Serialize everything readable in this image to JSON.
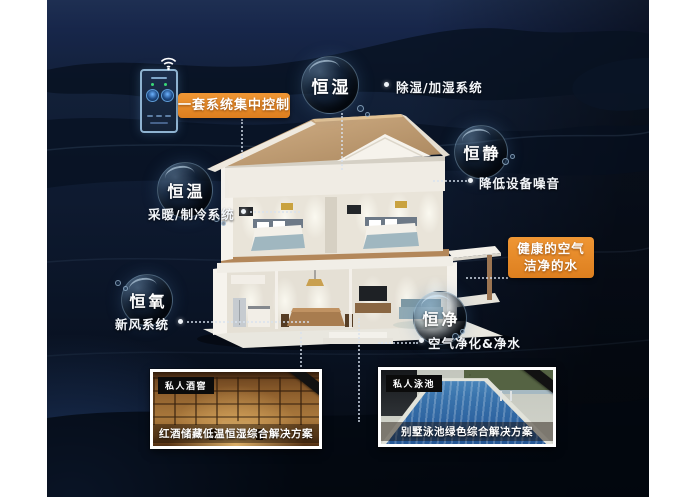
{
  "scene": {
    "control_label": "一套系统集中控制",
    "healthy_line1": "健康的空气",
    "healthy_line2": "洁净的水"
  },
  "bubbles": {
    "humidity": {
      "name": "恒湿",
      "note": "除湿/加湿系统"
    },
    "quiet": {
      "name": "恒静",
      "note": "降低设备噪音"
    },
    "temperature": {
      "name": "恒温",
      "note": "采暖/制冷系统"
    },
    "oxygen": {
      "name": "恒氧",
      "note": "新风系统"
    },
    "purity": {
      "name": "恒净",
      "note": "空气净化&净水"
    }
  },
  "photos": {
    "wine": {
      "tag": "私人酒窖",
      "caption": "红酒储藏低温恒湿综合解决方案"
    },
    "pool": {
      "tag": "私人泳池",
      "caption": "别墅泳池绿色综合解决方案"
    }
  },
  "icons": {
    "wifi": "wifi-icon",
    "panel": "smart-control-panel"
  },
  "colors": {
    "accent_orange": "#E5882A",
    "bubble_rim": "#9FC4DE",
    "background_navy": "#101D36",
    "text": "#FFFFFF"
  }
}
